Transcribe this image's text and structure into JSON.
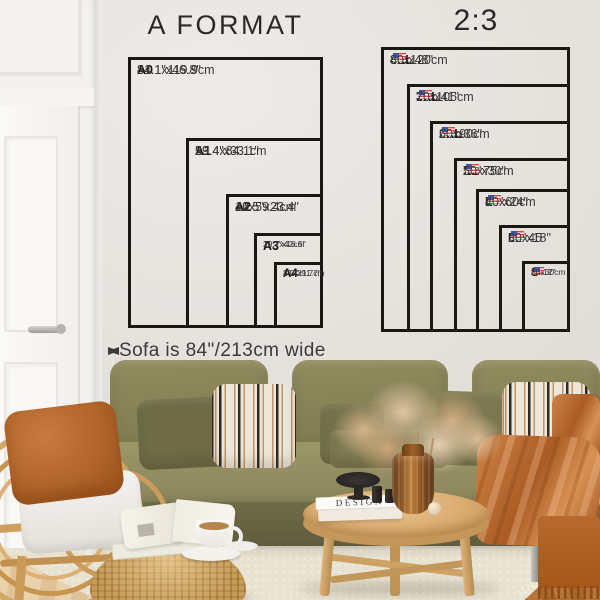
{
  "charts": {
    "a_format": {
      "title": "A FORMAT",
      "sizes": [
        {
          "tag": "A0",
          "inches": "31.1\"x46.8\"",
          "cm": "84.1x119.9cm"
        },
        {
          "tag": "A1",
          "inches": "23.4\"x33.1\"",
          "cm": "59.4x84.1cm"
        },
        {
          "tag": "A2",
          "inches": "16.5\"x23.4\"",
          "cm": "42x59.4cm"
        },
        {
          "tag": "A3",
          "inches": "11.7\"x16.5\"",
          "cm": "29.7x42cm"
        },
        {
          "tag": "A4",
          "inches": "8.3\"x11.7\"",
          "cm": "21x29.7cm"
        }
      ]
    },
    "ratio_2_3": {
      "title": "2:3",
      "sizes": [
        {
          "tag": "4XL",
          "inches": "32\"x48\"",
          "cm": "80x120cm",
          "flag": "us"
        },
        {
          "tag": "3XL",
          "inches": "27\"x41\"",
          "cm": "70x105cm",
          "flag": "us"
        },
        {
          "tag": "2XL",
          "inches": "24\"x36\"",
          "cm": "60x90cm",
          "flag": "us"
        },
        {
          "tag": "XL",
          "inches": "20\"x30\"",
          "cm": "50x75cm",
          "flag": "us"
        },
        {
          "tag": "L",
          "inches": "16\"x24\"",
          "cm": "40x60cm",
          "flag": "us"
        },
        {
          "tag": "M",
          "inches": "12\"x18\"",
          "cm": "30x45",
          "flag": "us"
        },
        {
          "tag": "S",
          "inches": "8\"x12\"",
          "cm": "20x30cm",
          "flag": "us"
        }
      ]
    }
  },
  "annotation": {
    "sofa_width_label": "Sofa is 84\"/213cm wide"
  },
  "decor": {
    "book_title": "DESIGN"
  },
  "palette": {
    "chart_line": "#1b1814",
    "wall": "#e4e1dc",
    "sofa_olive": "#878357",
    "pillow_rust": "#b5682f",
    "blanket_rust": "#b4672e",
    "rattan": "#cda162",
    "table_wood": "#d9ab70",
    "floor_wood": "#b3753a",
    "rug": "#e8e2d1"
  }
}
